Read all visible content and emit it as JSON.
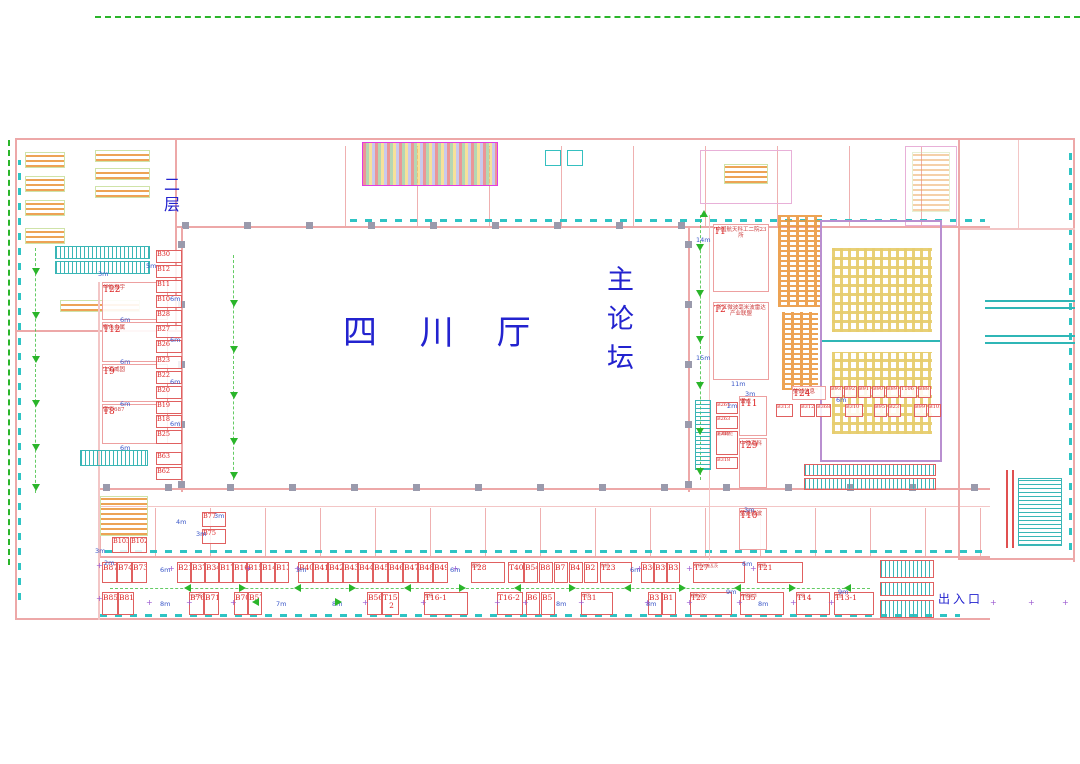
{
  "labels": {
    "hall_name": "四 川 厅",
    "forum_name": "主论坛",
    "floor_label": "二层",
    "entrance_label": "出入口"
  },
  "colors": {
    "booth_red": "#dd2424",
    "label_blue": "#2323cf",
    "aisle_green": "#2ab52a",
    "teal": "#2fb6b6",
    "wall_pink": "#eda8a8"
  },
  "t_booths": [
    {
      "id": "T22",
      "sub": "华能振宇",
      "x": 102,
      "y": 282,
      "w": 66,
      "h": 38
    },
    {
      "id": "T12",
      "sub": "有色金属",
      "x": 102,
      "y": 322,
      "w": 66,
      "h": 40
    },
    {
      "id": "T9",
      "sub": "上海威固",
      "x": 102,
      "y": 364,
      "w": 66,
      "h": 38
    },
    {
      "id": "T8",
      "sub": "雷华687",
      "x": 102,
      "y": 404,
      "w": 66,
      "h": 40
    },
    {
      "id": "T1",
      "sub": "中国航天科工二院23所",
      "x": 713,
      "y": 224,
      "w": 56,
      "h": 68
    },
    {
      "id": "T2",
      "sub": "浙江微波毫米波雷达产业联盟",
      "x": 713,
      "y": 302,
      "w": 56,
      "h": 78
    },
    {
      "id": "T11",
      "sub": "谱成",
      "x": 739,
      "y": 396,
      "w": 28,
      "h": 40
    },
    {
      "id": "T29",
      "sub": "中微高科",
      "x": 739,
      "y": 438,
      "w": 28,
      "h": 50
    },
    {
      "id": "T10",
      "sub": "蓝菱微波",
      "x": 739,
      "y": 508,
      "w": 28,
      "h": 42
    },
    {
      "id": "T24",
      "sub": "美诚信息",
      "x": 792,
      "y": 386,
      "w": 34,
      "h": 14
    }
  ],
  "b_column": [
    {
      "id": "B30",
      "x": 156,
      "y": 250,
      "w": 26,
      "h": 13
    },
    {
      "id": "B12",
      "x": 156,
      "y": 265,
      "w": 26,
      "h": 13
    },
    {
      "id": "B11",
      "x": 156,
      "y": 280,
      "w": 26,
      "h": 13
    },
    {
      "id": "B10",
      "x": 156,
      "y": 295,
      "w": 26,
      "h": 13
    },
    {
      "id": "B28",
      "x": 156,
      "y": 310,
      "w": 26,
      "h": 13
    },
    {
      "id": "B27",
      "x": 156,
      "y": 325,
      "w": 26,
      "h": 13
    },
    {
      "id": "B26",
      "x": 156,
      "y": 340,
      "w": 26,
      "h": 13
    },
    {
      "id": "B23",
      "x": 156,
      "y": 356,
      "w": 26,
      "h": 13
    },
    {
      "id": "B22",
      "x": 156,
      "y": 371,
      "w": 26,
      "h": 13
    },
    {
      "id": "B20",
      "x": 156,
      "y": 386,
      "w": 26,
      "h": 13
    },
    {
      "id": "B19",
      "x": 156,
      "y": 401,
      "w": 26,
      "h": 13
    },
    {
      "id": "B18",
      "x": 156,
      "y": 415,
      "w": 26,
      "h": 13
    },
    {
      "id": "B25",
      "x": 156,
      "y": 430,
      "w": 26,
      "h": 14
    },
    {
      "id": "B63",
      "x": 156,
      "y": 452,
      "w": 26,
      "h": 13
    },
    {
      "id": "B62",
      "x": 156,
      "y": 467,
      "w": 26,
      "h": 13
    },
    {
      "id": "B77",
      "x": 202,
      "y": 512,
      "w": 24,
      "h": 15
    },
    {
      "id": "B75",
      "x": 202,
      "y": 529,
      "w": 24,
      "h": 15
    },
    {
      "id": "B103",
      "x": 112,
      "y": 537,
      "w": 17,
      "h": 16
    },
    {
      "id": "B102",
      "x": 130,
      "y": 537,
      "w": 17,
      "h": 16
    }
  ],
  "mid_right_row1": [
    {
      "id": "B93",
      "x": 830,
      "y": 386,
      "w": 13,
      "h": 12
    },
    {
      "id": "B92",
      "x": 844,
      "y": 386,
      "w": 13,
      "h": 12
    },
    {
      "id": "B91",
      "x": 858,
      "y": 386,
      "w": 13,
      "h": 12
    },
    {
      "id": "B90",
      "x": 872,
      "y": 386,
      "w": 13,
      "h": 12
    },
    {
      "id": "B89",
      "x": 886,
      "y": 386,
      "w": 13,
      "h": 12
    },
    {
      "id": "T106",
      "x": 900,
      "y": 386,
      "w": 17,
      "h": 12
    },
    {
      "id": "B88",
      "x": 918,
      "y": 386,
      "w": 13,
      "h": 12
    }
  ],
  "mid_right_row2": [
    {
      "id": "B313",
      "x": 776,
      "y": 404,
      "w": 17,
      "h": 13
    },
    {
      "id": "B312",
      "x": 800,
      "y": 404,
      "w": 15,
      "h": 13
    },
    {
      "id": "B368",
      "x": 816,
      "y": 404,
      "w": 15,
      "h": 13
    },
    {
      "id": "B310",
      "x": 845,
      "y": 404,
      "w": 18,
      "h": 13
    },
    {
      "id": "B95",
      "x": 874,
      "y": 404,
      "w": 13,
      "h": 13
    },
    {
      "id": "B23",
      "x": 888,
      "y": 404,
      "w": 13,
      "h": 13
    },
    {
      "id": "B99",
      "x": 914,
      "y": 404,
      "w": 13,
      "h": 13
    },
    {
      "id": "B101",
      "x": 928,
      "y": 404,
      "w": 13,
      "h": 13
    }
  ],
  "left_strip": [
    {
      "id": "B261",
      "x": 716,
      "y": 402,
      "w": 22,
      "h": 12
    },
    {
      "id": "B263",
      "x": 716,
      "y": 416,
      "w": 22,
      "h": 13
    },
    {
      "id": "B317",
      "sub": "上海雍伦",
      "x": 716,
      "y": 431,
      "w": 22,
      "h": 24
    },
    {
      "id": "B318",
      "x": 716,
      "y": 457,
      "w": 22,
      "h": 12
    }
  ],
  "row1_booths": [
    {
      "id": "B87",
      "x": 102,
      "w": 15
    },
    {
      "id": "B74",
      "x": 117,
      "w": 15
    },
    {
      "id": "B73",
      "x": 132,
      "w": 15
    },
    {
      "id": "B21",
      "x": 177,
      "w": 14
    },
    {
      "id": "B37",
      "x": 191,
      "w": 14
    },
    {
      "id": "B34",
      "x": 205,
      "w": 14
    },
    {
      "id": "B17",
      "x": 219,
      "w": 14
    },
    {
      "id": "B16",
      "x": 233,
      "w": 14
    },
    {
      "id": "B15",
      "x": 247,
      "w": 14
    },
    {
      "id": "B14",
      "x": 261,
      "w": 14
    },
    {
      "id": "B13",
      "x": 275,
      "w": 14
    },
    {
      "id": "B40",
      "x": 298,
      "w": 15
    },
    {
      "id": "B41",
      "x": 313,
      "w": 15
    },
    {
      "id": "B42",
      "x": 328,
      "w": 15
    },
    {
      "id": "B43",
      "x": 343,
      "w": 15
    },
    {
      "id": "B44",
      "x": 358,
      "w": 15
    },
    {
      "id": "B45",
      "x": 373,
      "w": 15
    },
    {
      "id": "B46",
      "x": 388,
      "w": 15
    },
    {
      "id": "B47",
      "x": 403,
      "w": 15
    },
    {
      "id": "B48",
      "x": 418,
      "w": 15
    },
    {
      "id": "B49",
      "x": 433,
      "w": 15
    },
    {
      "id": "T28",
      "sub": "蓝科",
      "x": 471,
      "w": 34
    },
    {
      "id": "T40",
      "x": 508,
      "w": 16
    },
    {
      "id": "B54",
      "x": 524,
      "w": 14
    },
    {
      "id": "B8",
      "x": 539,
      "w": 14
    },
    {
      "id": "B7",
      "x": 554,
      "w": 14
    },
    {
      "id": "B4",
      "x": 569,
      "w": 14
    },
    {
      "id": "B2",
      "x": 584,
      "w": 14
    },
    {
      "id": "T23",
      "sub": "为恒",
      "x": 600,
      "w": 32
    },
    {
      "id": "B36",
      "x": 641,
      "w": 13
    },
    {
      "id": "B39",
      "x": 654,
      "w": 13
    },
    {
      "id": "B35",
      "x": 667,
      "w": 13
    },
    {
      "id": "T27",
      "sub": "罗德与施瓦茨",
      "x": 693,
      "w": 52
    },
    {
      "id": "T21",
      "sub": "是德",
      "x": 757,
      "w": 46
    }
  ],
  "row2_booths": [
    {
      "id": "B85",
      "x": 102,
      "w": 16
    },
    {
      "id": "B81",
      "x": 118,
      "w": 16
    },
    {
      "id": "B76",
      "sub": "十二所",
      "x": 189,
      "w": 15
    },
    {
      "id": "B71",
      "x": 204,
      "w": 15
    },
    {
      "id": "B70",
      "x": 234,
      "w": 14
    },
    {
      "id": "B57",
      "x": 248,
      "w": 14
    },
    {
      "id": "B56",
      "x": 367,
      "w": 15
    },
    {
      "id": "T15-2",
      "x": 382,
      "w": 17
    },
    {
      "id": "T16-1",
      "sub": "宝德",
      "x": 424,
      "w": 44
    },
    {
      "id": "T16-2",
      "x": 497,
      "w": 26
    },
    {
      "id": "B6",
      "x": 526,
      "w": 14
    },
    {
      "id": "B5",
      "x": 541,
      "w": 14
    },
    {
      "id": "T31",
      "sub": "华正",
      "x": 581,
      "w": 32
    },
    {
      "id": "B3",
      "x": 648,
      "w": 14
    },
    {
      "id": "B1",
      "x": 662,
      "w": 14
    },
    {
      "id": "T25",
      "sub": "模数汇仪",
      "x": 690,
      "w": 42
    },
    {
      "id": "T35",
      "sub": "中星联华",
      "x": 740,
      "w": 44
    },
    {
      "id": "T14",
      "sub": "世强",
      "x": 796,
      "w": 34
    },
    {
      "id": "T13-1",
      "sub": "生益",
      "x": 834,
      "w": 40
    }
  ],
  "dims": [
    {
      "t": "5m",
      "x": 146,
      "y": 262
    },
    {
      "t": "3m",
      "x": 98,
      "y": 270
    },
    {
      "t": "6m",
      "x": 170,
      "y": 295
    },
    {
      "t": "6m",
      "x": 120,
      "y": 316
    },
    {
      "t": "6m",
      "x": 170,
      "y": 336
    },
    {
      "t": "6m",
      "x": 120,
      "y": 358
    },
    {
      "t": "6m",
      "x": 170,
      "y": 378
    },
    {
      "t": "6m",
      "x": 120,
      "y": 400
    },
    {
      "t": "6m",
      "x": 170,
      "y": 420
    },
    {
      "t": "6m",
      "x": 120,
      "y": 444
    },
    {
      "t": "14m",
      "x": 696,
      "y": 236
    },
    {
      "t": "15m",
      "x": 696,
      "y": 354
    },
    {
      "t": "11m",
      "x": 731,
      "y": 380
    },
    {
      "t": "3m",
      "x": 745,
      "y": 390
    },
    {
      "t": "2m",
      "x": 727,
      "y": 402
    },
    {
      "t": "6m",
      "x": 836,
      "y": 396
    },
    {
      "t": "3m",
      "x": 214,
      "y": 512
    },
    {
      "t": "4m",
      "x": 176,
      "y": 518
    },
    {
      "t": "3m",
      "x": 196,
      "y": 530
    },
    {
      "t": "3m",
      "x": 95,
      "y": 547
    },
    {
      "t": "3m",
      "x": 744,
      "y": 506
    },
    {
      "t": "2m",
      "x": 104,
      "y": 559
    },
    {
      "t": "6m",
      "x": 160,
      "y": 566
    },
    {
      "t": "3m",
      "x": 296,
      "y": 566
    },
    {
      "t": "6m",
      "x": 450,
      "y": 566
    },
    {
      "t": "6m",
      "x": 630,
      "y": 566
    },
    {
      "t": "6m",
      "x": 742,
      "y": 560
    },
    {
      "t": "8m",
      "x": 160,
      "y": 600
    },
    {
      "t": "7m",
      "x": 276,
      "y": 600
    },
    {
      "t": "8m",
      "x": 332,
      "y": 600
    },
    {
      "t": "8m",
      "x": 556,
      "y": 600
    },
    {
      "t": "8m",
      "x": 646,
      "y": 600
    },
    {
      "t": "9m",
      "x": 726,
      "y": 588
    },
    {
      "t": "9m",
      "x": 838,
      "y": 588
    },
    {
      "t": "8m",
      "x": 758,
      "y": 600
    }
  ],
  "arrows": [
    {
      "d": "down",
      "x": 32,
      "y": 268
    },
    {
      "d": "down",
      "x": 32,
      "y": 312
    },
    {
      "d": "down",
      "x": 32,
      "y": 356
    },
    {
      "d": "down",
      "x": 32,
      "y": 400
    },
    {
      "d": "down",
      "x": 32,
      "y": 444
    },
    {
      "d": "down",
      "x": 32,
      "y": 484
    },
    {
      "d": "down",
      "x": 230,
      "y": 300
    },
    {
      "d": "down",
      "x": 230,
      "y": 346
    },
    {
      "d": "down",
      "x": 230,
      "y": 392
    },
    {
      "d": "down",
      "x": 230,
      "y": 438
    },
    {
      "d": "down",
      "x": 230,
      "y": 472
    },
    {
      "d": "down",
      "x": 696,
      "y": 244
    },
    {
      "d": "down",
      "x": 696,
      "y": 290
    },
    {
      "d": "down",
      "x": 696,
      "y": 336
    },
    {
      "d": "down",
      "x": 696,
      "y": 382
    },
    {
      "d": "down",
      "x": 696,
      "y": 428
    },
    {
      "d": "down",
      "x": 696,
      "y": 468
    },
    {
      "d": "up",
      "x": 700,
      "y": 210
    },
    {
      "d": "left",
      "x": 184,
      "y": 584
    },
    {
      "d": "right",
      "x": 239,
      "y": 584
    },
    {
      "d": "left",
      "x": 294,
      "y": 584
    },
    {
      "d": "right",
      "x": 349,
      "y": 584
    },
    {
      "d": "left",
      "x": 404,
      "y": 584
    },
    {
      "d": "right",
      "x": 459,
      "y": 584
    },
    {
      "d": "left",
      "x": 514,
      "y": 584
    },
    {
      "d": "right",
      "x": 569,
      "y": 584
    },
    {
      "d": "left",
      "x": 624,
      "y": 584
    },
    {
      "d": "right",
      "x": 679,
      "y": 584
    },
    {
      "d": "left",
      "x": 734,
      "y": 584
    },
    {
      "d": "right",
      "x": 789,
      "y": 584
    },
    {
      "d": "left",
      "x": 844,
      "y": 584
    },
    {
      "d": "left",
      "x": 252,
      "y": 598
    },
    {
      "d": "right",
      "x": 335,
      "y": 598
    }
  ],
  "plus_marks": [
    {
      "x": 96,
      "y": 562
    },
    {
      "x": 168,
      "y": 565
    },
    {
      "x": 245,
      "y": 565
    },
    {
      "x": 294,
      "y": 565
    },
    {
      "x": 452,
      "y": 565
    },
    {
      "x": 636,
      "y": 565
    },
    {
      "x": 686,
      "y": 565
    },
    {
      "x": 750,
      "y": 565
    },
    {
      "x": 96,
      "y": 595
    },
    {
      "x": 146,
      "y": 599
    },
    {
      "x": 186,
      "y": 599
    },
    {
      "x": 230,
      "y": 599
    },
    {
      "x": 362,
      "y": 599
    },
    {
      "x": 420,
      "y": 599
    },
    {
      "x": 494,
      "y": 599
    },
    {
      "x": 522,
      "y": 599
    },
    {
      "x": 578,
      "y": 599
    },
    {
      "x": 644,
      "y": 599
    },
    {
      "x": 686,
      "y": 599
    },
    {
      "x": 736,
      "y": 599
    },
    {
      "x": 790,
      "y": 599
    },
    {
      "x": 828,
      "y": 599
    },
    {
      "x": 990,
      "y": 599
    },
    {
      "x": 1028,
      "y": 599
    },
    {
      "x": 1062,
      "y": 599
    }
  ]
}
